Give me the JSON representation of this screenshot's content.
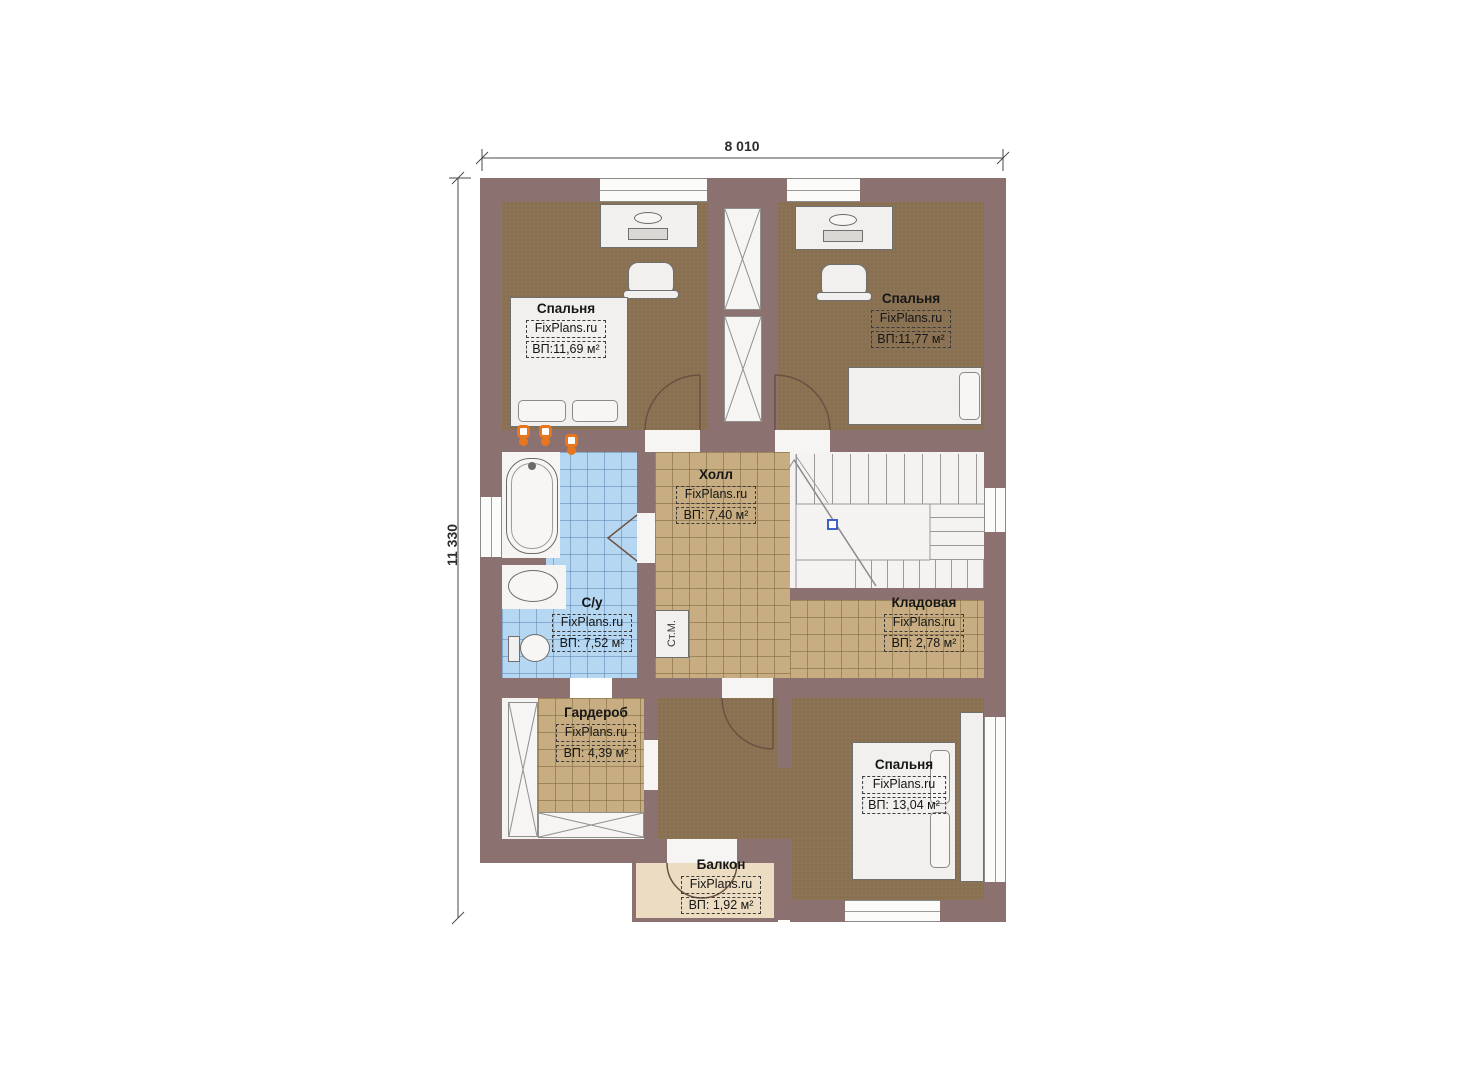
{
  "plan": {
    "dimensions": {
      "width_label": "8 010",
      "height_label": "11 330"
    },
    "rooms": {
      "bedroom_top_left": {
        "name": "Спальня",
        "brand": "FixPlans.ru",
        "area": "ВП:11,69 м²"
      },
      "bedroom_top_right": {
        "name": "Спальня",
        "brand": "FixPlans.ru",
        "area": "ВП:11,77 м²"
      },
      "hall": {
        "name": "Холл",
        "brand": "FixPlans.ru",
        "area": "ВП: 7,40 м²"
      },
      "bathroom": {
        "name": "С/у",
        "brand": "FixPlans.ru",
        "area": "ВП: 7,52 м²"
      },
      "storage": {
        "name": "Кладовая",
        "brand": "FixPlans.ru",
        "area": "ВП: 2,78 м²"
      },
      "wardrobe": {
        "name": "Гардероб",
        "brand": "FixPlans.ru",
        "area": "ВП: 4,39 м²"
      },
      "bedroom_bottom": {
        "name": "Спальня",
        "brand": "FixPlans.ru",
        "area": "ВП: 13,04 м²"
      },
      "balcony": {
        "name": "Балкон",
        "brand": "FixPlans.ru",
        "area": "ВП: 1,92 м²"
      }
    },
    "appliances": {
      "washing_machine": "Ст.М."
    },
    "colors": {
      "wall": "#8b7170",
      "wood_floor": "#8c7354",
      "tile_tan": "#c7ad81",
      "tile_blue": "#b6d7f1",
      "balcony": "#ecdcc2",
      "fixture_white": "#f1f0ee",
      "accent_orange": "#e8761f",
      "stair_node_blue": "#3f62c9"
    }
  }
}
